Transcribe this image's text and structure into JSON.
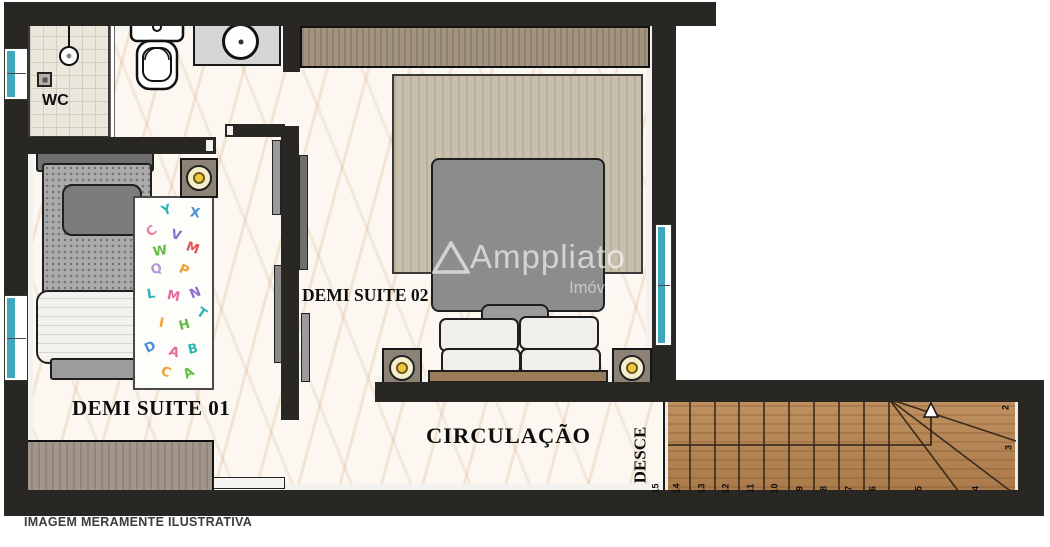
{
  "rooms": {
    "wc": "WC",
    "suite01": "DEMI SUITE 01",
    "suite02": "DEMI SUITE 02",
    "circulation": "CIRCULAÇÃO",
    "stair_direction": "DESCE"
  },
  "stairs": {
    "run_numbers": [
      "15",
      "14",
      "13",
      "12",
      "11",
      "10",
      "9",
      "8",
      "7",
      "6",
      "5",
      "4"
    ],
    "turn_numbers": [
      "2",
      "3"
    ]
  },
  "rug_letters": [
    {
      "ch": "Y",
      "color": "#2ab5b5"
    },
    {
      "ch": "X",
      "color": "#4a90d9"
    },
    {
      "ch": "C",
      "color": "#e87fa8"
    },
    {
      "ch": "V",
      "color": "#8a6fd0"
    },
    {
      "ch": "W",
      "color": "#66bb44"
    },
    {
      "ch": "M",
      "color": "#e05050"
    },
    {
      "ch": "Q",
      "color": "#b09ad6"
    },
    {
      "ch": "P",
      "color": "#f0a030"
    },
    {
      "ch": "L",
      "color": "#2ab5b5"
    },
    {
      "ch": "M",
      "color": "#e86aa0"
    },
    {
      "ch": "N",
      "color": "#8a6fd0"
    },
    {
      "ch": "T",
      "color": "#2ab5b5"
    },
    {
      "ch": "H",
      "color": "#66bb44"
    },
    {
      "ch": "I",
      "color": "#f0a030"
    },
    {
      "ch": "D",
      "color": "#4a90d9"
    },
    {
      "ch": "A",
      "color": "#e86aa0"
    },
    {
      "ch": "B",
      "color": "#2ab5b5"
    },
    {
      "ch": "C",
      "color": "#f0a030"
    },
    {
      "ch": "A",
      "color": "#66bb44"
    }
  ],
  "watermark": {
    "brand": "Amppliato",
    "subtitle": "Imóveis",
    "logo": "triangle-logo"
  },
  "caption": "IMAGEM MERAMENTE ILUSTRATIVA",
  "colors": {
    "wall": "#282724",
    "window_glass": "#3fa9bb",
    "stair_wood": "#b8844f",
    "marble_floor": "#fcf8f1"
  }
}
